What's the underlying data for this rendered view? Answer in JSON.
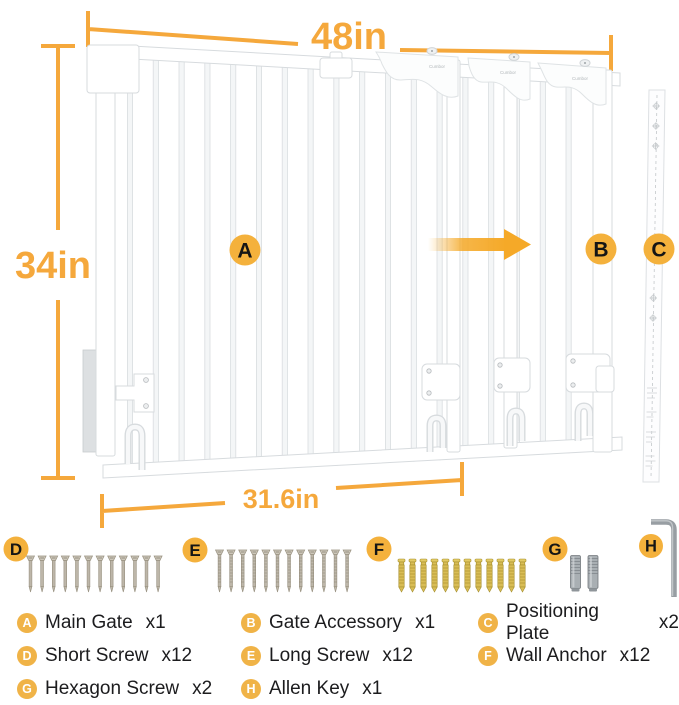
{
  "colors": {
    "accent": "#F5A83C",
    "badge_fill": "#F4B13C",
    "badge_letter": "#151515",
    "legend_badge_fill": "#F0B347",
    "legend_badge_letter": "#FFFFFF",
    "legend_text": "#1C1C1E",
    "screw_metal": "#BDB6A9",
    "anchor_gold": "#D9BD55",
    "steel_gray": "#A9AFB3"
  },
  "diagram": {
    "brand": "Cumbor",
    "dimensions": {
      "top": "48in",
      "left": "34in",
      "bottom": "31.6in"
    },
    "badges": {
      "main_gate": "A",
      "gate_accessory": "B",
      "positioning_plate": "C"
    }
  },
  "hardware": {
    "short_screws": {
      "letter": "D",
      "count": 12
    },
    "long_screws": {
      "letter": "E",
      "count": 12
    },
    "wall_anchors": {
      "letter": "F",
      "count": 12
    },
    "hexagon_screws": {
      "letter": "G",
      "count": 2
    },
    "allen_key": {
      "letter": "H",
      "count": 1
    }
  },
  "legend": {
    "items": [
      {
        "letter": "A",
        "label": "Main Gate",
        "count": "x1"
      },
      {
        "letter": "B",
        "label": "Gate Accessory",
        "count": "x1"
      },
      {
        "letter": "C",
        "label": "Positioning Plate",
        "count": "x2"
      },
      {
        "letter": "D",
        "label": "Short Screw",
        "count": "x12"
      },
      {
        "letter": "E",
        "label": "Long Screw",
        "count": "x12"
      },
      {
        "letter": "F",
        "label": "Wall Anchor",
        "count": "x12"
      },
      {
        "letter": "G",
        "label": "Hexagon Screw",
        "count": "x2"
      },
      {
        "letter": "H",
        "label": "Allen Key",
        "count": "x1"
      }
    ]
  }
}
